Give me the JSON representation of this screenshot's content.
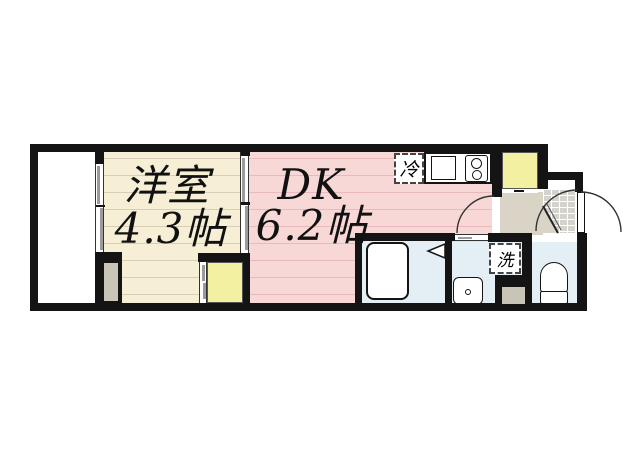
{
  "plan": {
    "title": "1DK apartment floor plan",
    "rooms": {
      "western_room": {
        "name": "洋室",
        "size": "4.3帖"
      },
      "dining_kitchen": {
        "name": "DK",
        "size": "6.2帖"
      }
    },
    "fixtures": {
      "refrigerator": "冷",
      "washing_machine": "洗"
    },
    "colors": {
      "wall": "#141414",
      "western_room_floor": "#f7eed6",
      "dk_floor": "#f8d7d7",
      "closet": "#f4f0a2",
      "hallway": "#d9d4c5",
      "wet_area": "#e3eef5",
      "entrance_tile": "#d4d3cd"
    }
  }
}
